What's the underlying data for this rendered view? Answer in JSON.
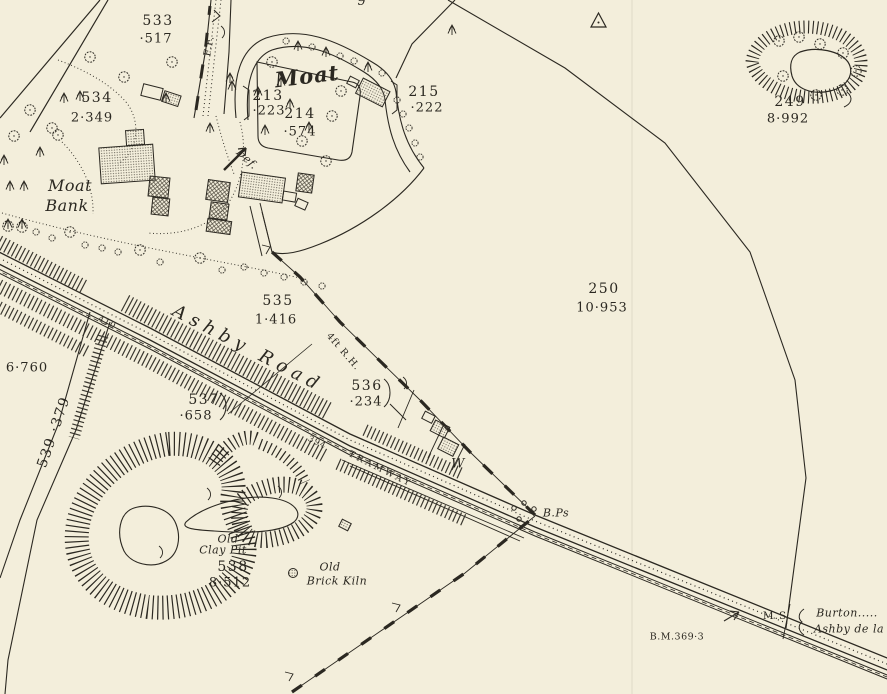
{
  "map_sheet": {
    "paper_color": "#f3eedb",
    "ink_color": "#2b2821",
    "parcels": {
      "p213": {
        "number": "213",
        "area": "·223"
      },
      "p214": {
        "number": "214",
        "area": "·574"
      },
      "p215": {
        "number": "215",
        "area": "·222"
      },
      "p249": {
        "number": "249",
        "area": "8·992"
      },
      "p250": {
        "number": "250",
        "area": "10·953"
      },
      "p533": {
        "number": "533",
        "area": "·517"
      },
      "p534": {
        "number": "534",
        "area": "2·349"
      },
      "p535": {
        "number": "535",
        "area": "1·416"
      },
      "p536": {
        "number": "536",
        "area": "·234"
      },
      "p537": {
        "number": "537",
        "area": "·658"
      },
      "p538": {
        "number": "538",
        "area": "8·512"
      },
      "p539": {
        "number": "539",
        "area": "·379"
      }
    },
    "labels": {
      "moat": "Moat",
      "moat_bank_line1": "Moat",
      "moat_bank_line2": "Bank",
      "ashby_road": "Ashby Road",
      "tramway": "TRAMWAY",
      "root_hedge": "4ft R.H.",
      "fence_mark": "F.F.",
      "defaced": "Def.",
      "well": "W",
      "clay_pit_line1": "Old",
      "clay_pit_line2": "Clay Pit",
      "brick_kiln_line1": "Old",
      "brick_kiln_line2": "Brick Kiln",
      "boundary_posts": "B.Ps",
      "bench_mark": "B.M.369·3",
      "mile_stone": "M.S",
      "destination_line1": "Burton.....",
      "destination_line2": "Ashby de la",
      "chainage_394": "394",
      "chainage_410": "410",
      "area_6760": "6·760",
      "clipped_number": "9"
    }
  }
}
